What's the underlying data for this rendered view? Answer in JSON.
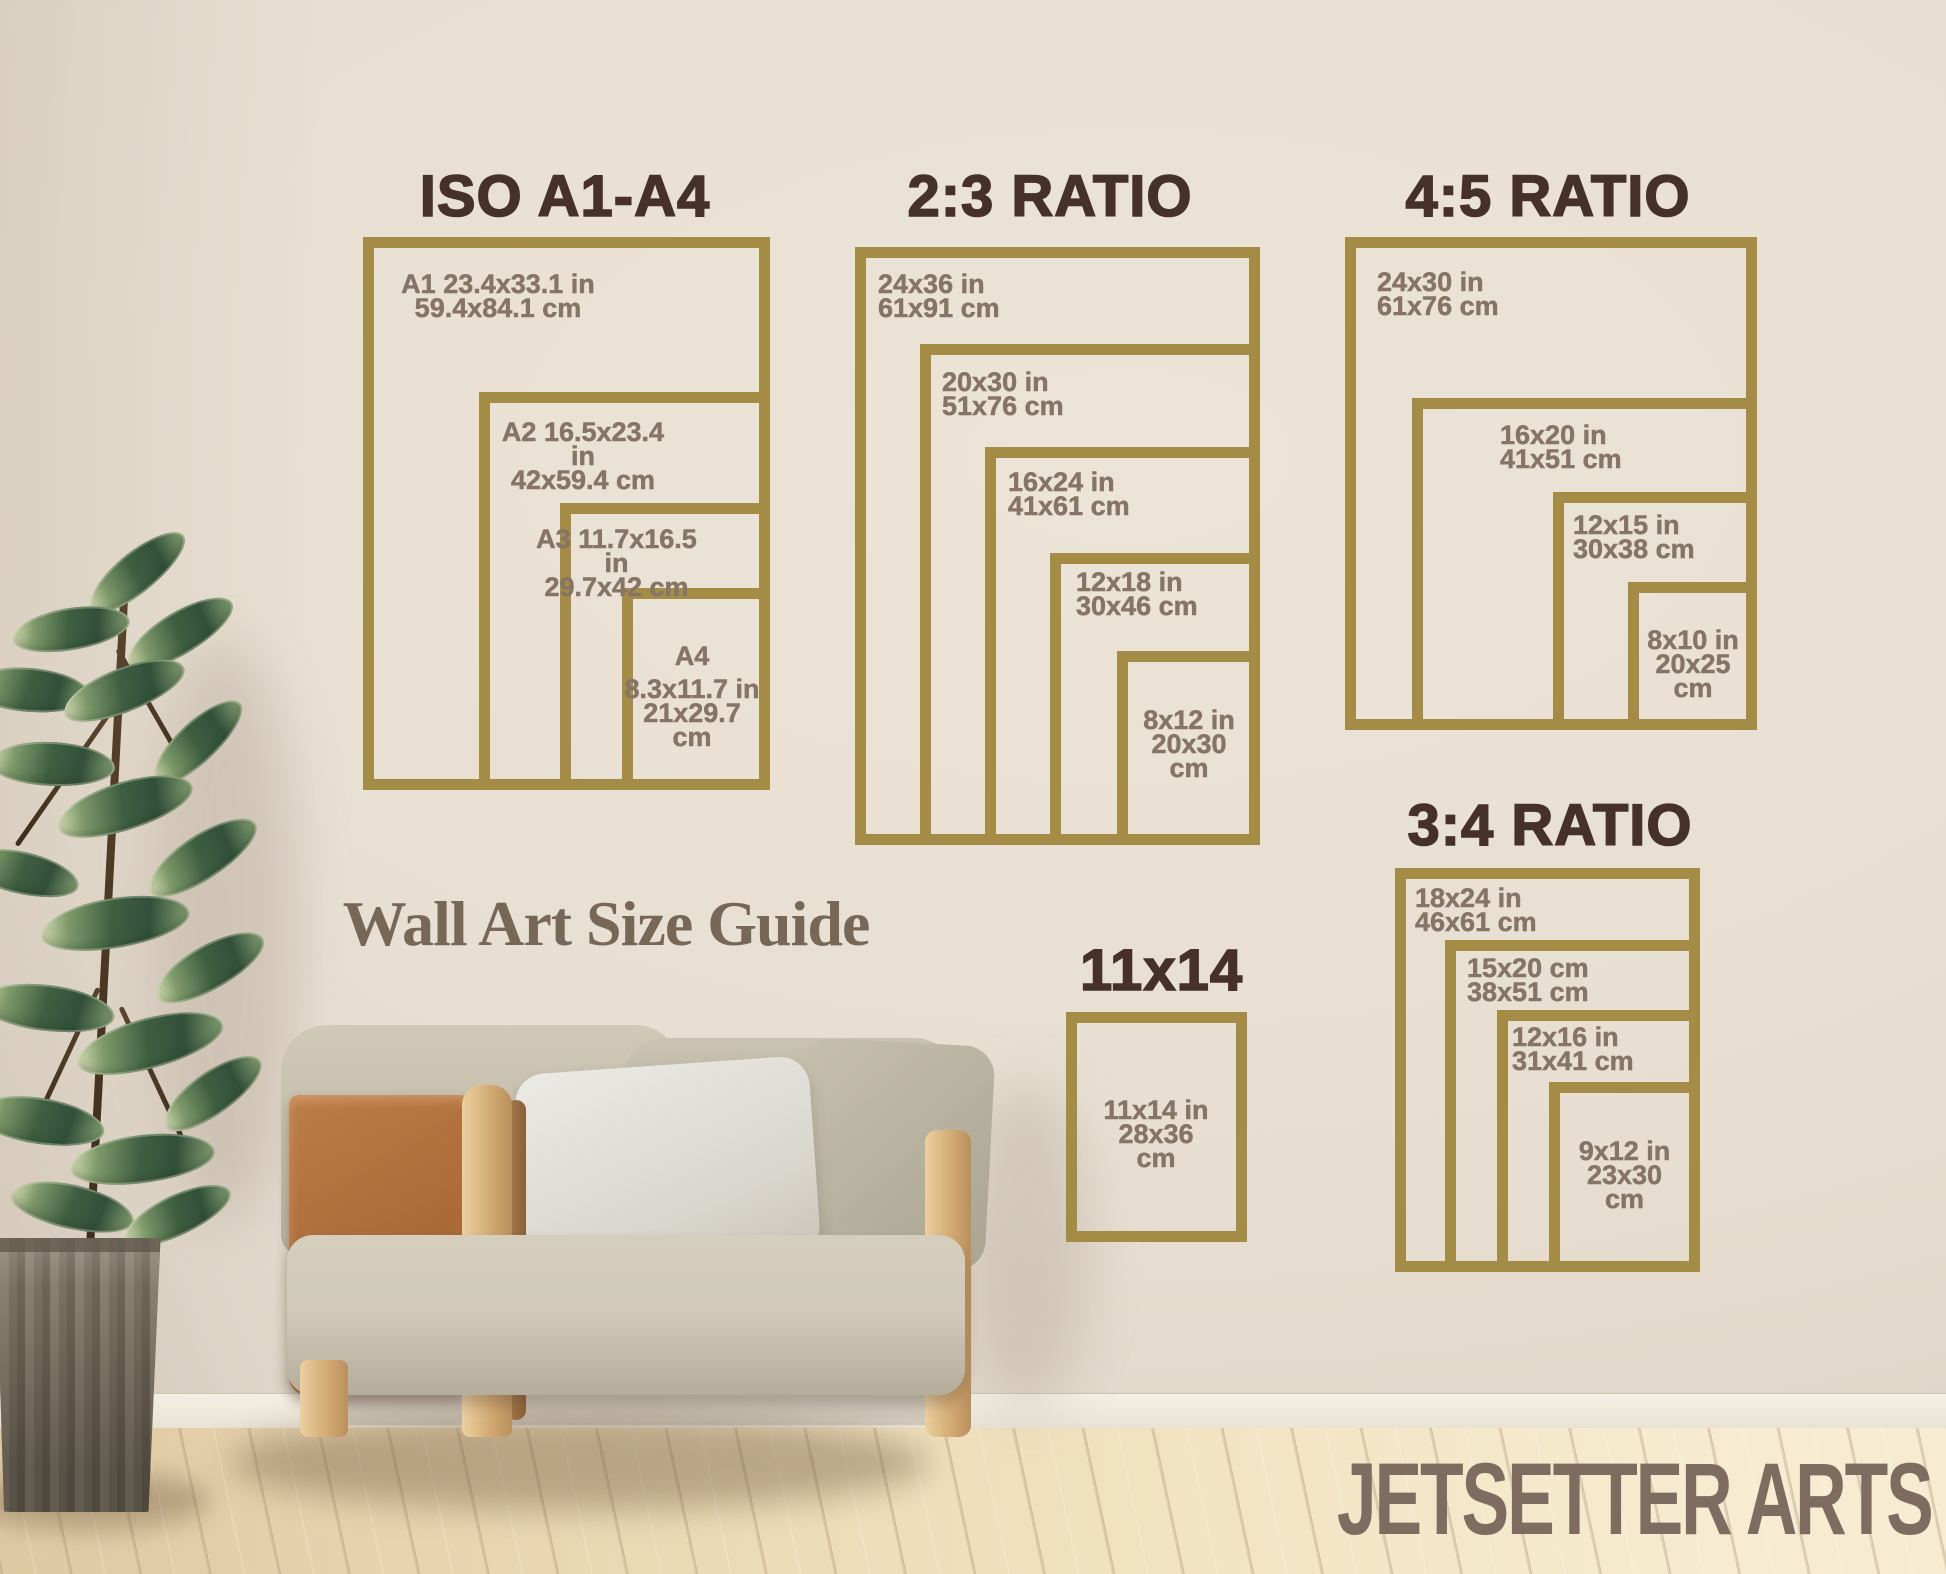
{
  "colors": {
    "gold": "#a58c46",
    "title": "#46302a",
    "label": "#867567",
    "tagline": "#776757",
    "brand": "#7d6c5f"
  },
  "tagline": "Wall Art Size Guide",
  "brand": "JETSETTER ARTS",
  "sections": {
    "iso": {
      "title": "ISO A1-A4",
      "boxes": [
        {
          "name": "A1",
          "lines": [
            "A1 23.4x33.1 in",
            "59.4x84.1 cm"
          ]
        },
        {
          "name": "A2",
          "lines": [
            "A2 16.5x23.4 in",
            "42x59.4 cm"
          ]
        },
        {
          "name": "A3",
          "lines": [
            "A3 11.7x16.5 in",
            "29.7x42 cm"
          ]
        },
        {
          "name": "A4",
          "lines": [
            "A4",
            "8.3x11.7 in",
            "21x29.7",
            "cm"
          ]
        }
      ]
    },
    "r23": {
      "title": "2:3 RATIO",
      "boxes": [
        {
          "lines": [
            "24x36 in",
            "61x91 cm"
          ]
        },
        {
          "lines": [
            "20x30 in",
            "51x76 cm"
          ]
        },
        {
          "lines": [
            "16x24 in",
            "41x61 cm"
          ]
        },
        {
          "lines": [
            "12x18 in",
            "30x46 cm"
          ]
        },
        {
          "lines": [
            "8x12 in",
            "20x30",
            "cm"
          ]
        }
      ]
    },
    "r45": {
      "title": "4:5 RATIO",
      "boxes": [
        {
          "lines": [
            "24x30 in",
            "61x76 cm"
          ]
        },
        {
          "lines": [
            "16x20 in",
            "41x51 cm"
          ]
        },
        {
          "lines": [
            "12x15 in",
            "30x38 cm"
          ]
        },
        {
          "lines": [
            "8x10 in",
            "20x25",
            "cm"
          ]
        }
      ]
    },
    "r34": {
      "title": "3:4 RATIO",
      "boxes": [
        {
          "lines": [
            "18x24 in",
            "46x61 cm"
          ]
        },
        {
          "lines": [
            "15x20 cm",
            "38x51 cm"
          ]
        },
        {
          "lines": [
            "12x16 in",
            "31x41 cm"
          ]
        },
        {
          "lines": [
            "9x12 in",
            "23x30",
            "cm"
          ]
        }
      ]
    },
    "s1114": {
      "title": "11x14",
      "boxes": [
        {
          "lines": [
            "11x14 in",
            "28x36",
            "cm"
          ]
        }
      ]
    }
  }
}
